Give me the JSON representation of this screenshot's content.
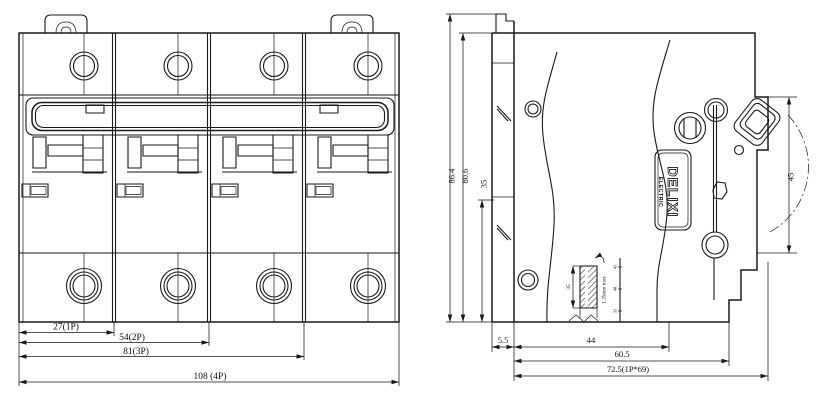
{
  "drawing": {
    "front_view": {
      "dim_1p": "27(1P)",
      "dim_2p": "54(2P)",
      "dim_3p": "81(3P)",
      "dim_4p": "108 (4P)"
    },
    "side_view": {
      "dim_height_total": "86.4",
      "dim_height_body": "80.6",
      "dim_rail_to_bottom": "35",
      "dim_front_depth": "45",
      "dim_back_offset": "5.5",
      "dim_mid_depth": "44",
      "dim_lower_depth": "60.5",
      "dim_total_depth": "72.5(1P*69)",
      "brand_label": {
        "name": "DELIXI",
        "sub": "ELECTRIC"
      },
      "rail_detail": {
        "rail_width": "35",
        "note": "1.35mm max",
        "tick_labels": [
          "45",
          "40",
          "35"
        ]
      }
    },
    "colors": {
      "line": "#1a1a1a",
      "background": "#ffffff"
    }
  }
}
